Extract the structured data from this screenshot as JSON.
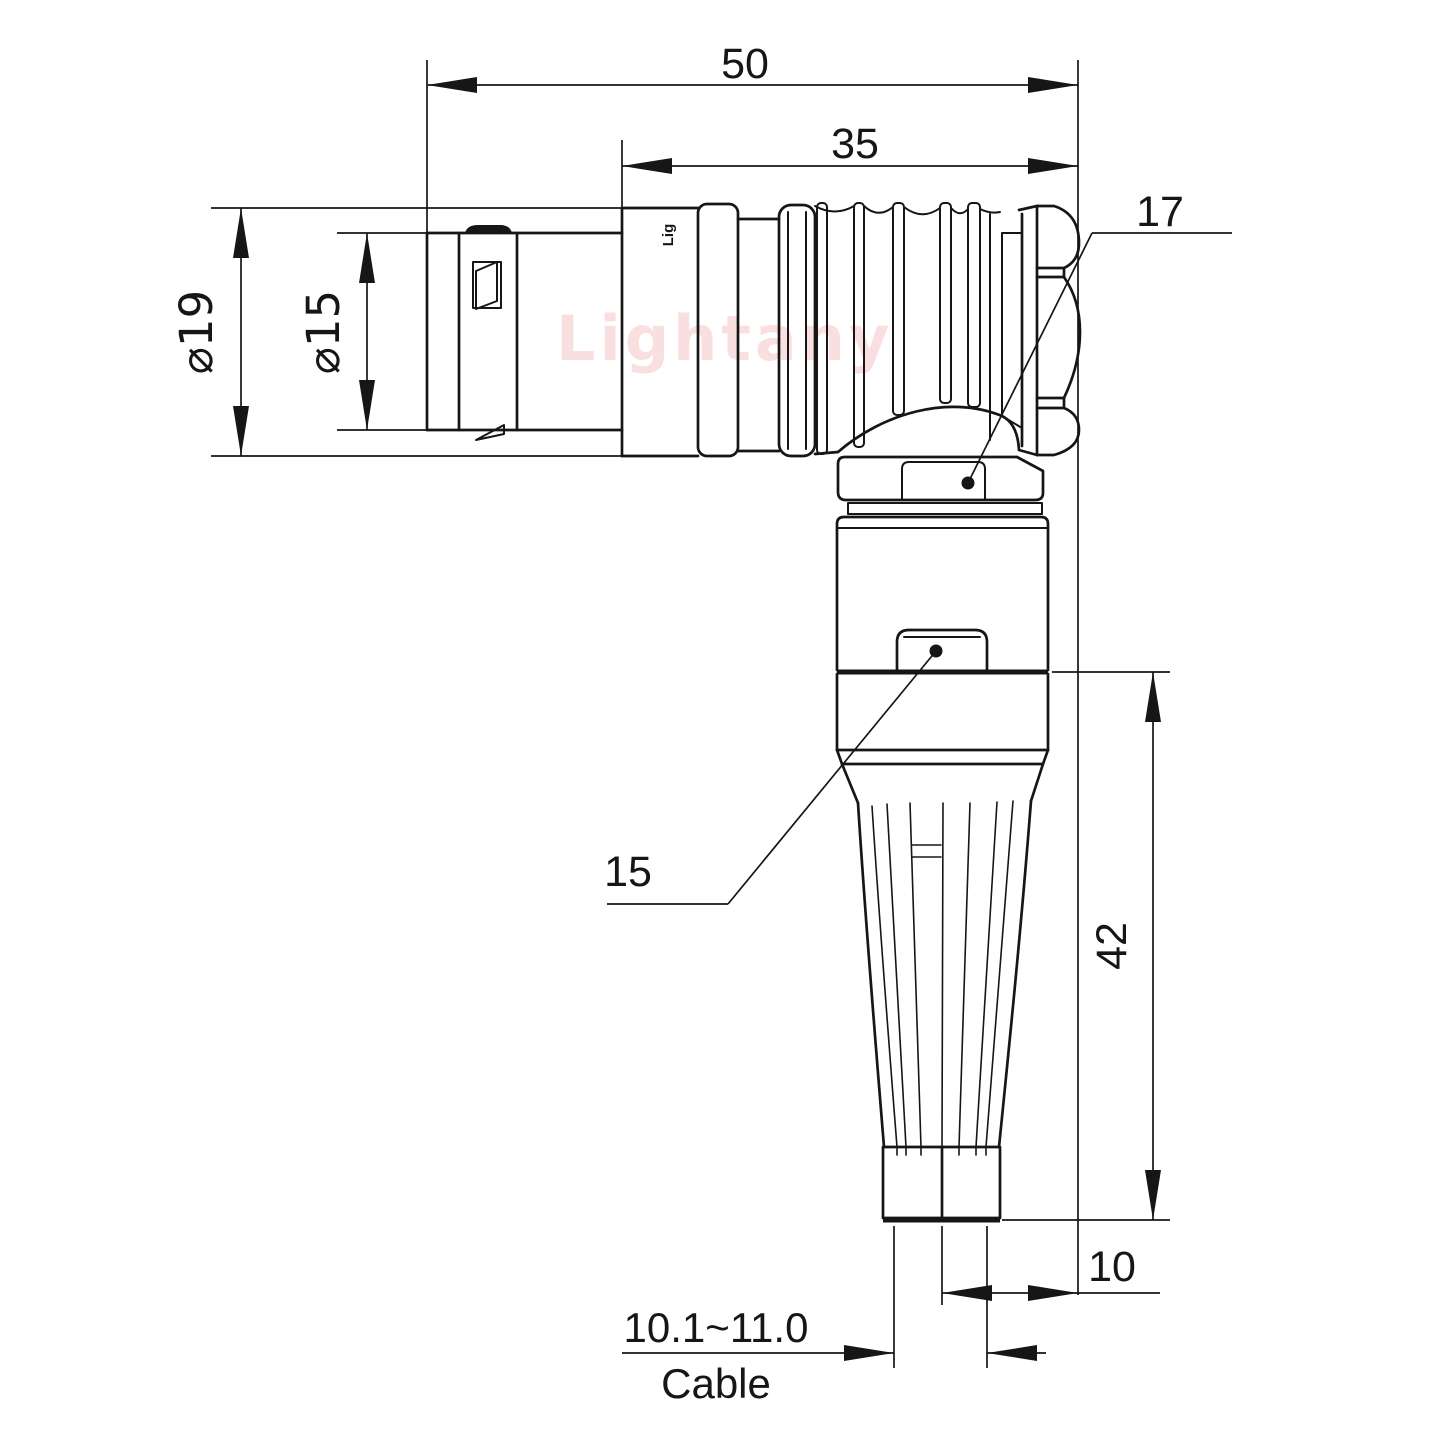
{
  "page": {
    "background": "#ffffff",
    "line_color": "#161616",
    "watermark_color": "#f5c5c5"
  },
  "drawing": {
    "watermark": "Lightany",
    "shell_marking": "Lig",
    "labels": {
      "dim50": "50",
      "dim35": "35",
      "dia19": "⌀19",
      "dia15": "⌀15",
      "label17": "17",
      "label15": "15",
      "dim42": "42",
      "dim10": "10",
      "cable_range": "10.1~11.0",
      "cable": "Cable"
    }
  }
}
